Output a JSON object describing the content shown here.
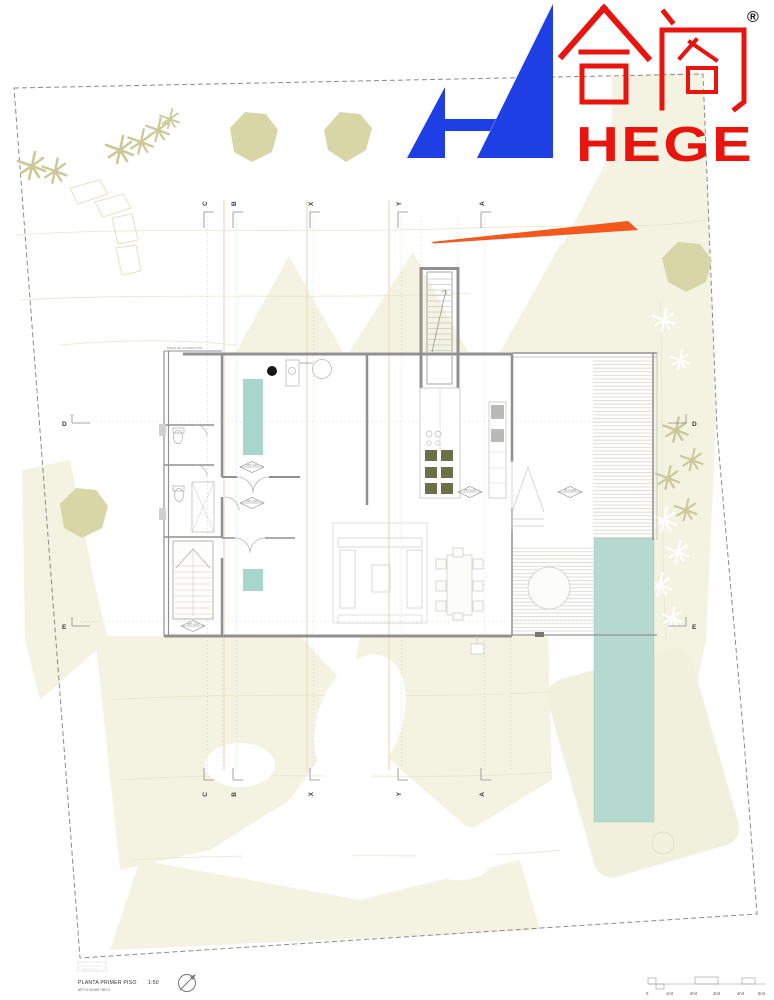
{
  "logo": {
    "cjk": "合阁",
    "registered": "®",
    "wordmark": "HEGE"
  },
  "grid": {
    "columns": [
      "C",
      "B",
      "X",
      "Y",
      "A"
    ],
    "rows": [
      "D",
      "E"
    ]
  },
  "annotations": {
    "wall_note": "MURO DE CONTENCIÓN",
    "room_label": "BODEGA",
    "level_tags": [
      "NPT +0,10",
      "NPT +0,10",
      "NPT +0,10",
      "NPT +0,10",
      "NPT +0,10"
    ]
  },
  "title_block": {
    "drawing_title": "PLANTA PRIMER PISO",
    "drawing_scale": "1:50",
    "levels_note": "NPT+0,00;NNT+991,5"
  },
  "scale_bar": {
    "labels": [
      "0",
      "1mt",
      "2mt",
      "3mt",
      "4mt",
      "5mt"
    ]
  },
  "colors": {
    "logo_blue": "#1d3fe3",
    "logo_red": "#e8140d",
    "accent_orange": "#f4581d",
    "pool_teal": "#b5d9ce",
    "rug_teal": "#a9d6ca",
    "tree_olive": "#d8d6a7",
    "terrain_cream": "#f4f3e2",
    "wall_gray": "#909090"
  }
}
